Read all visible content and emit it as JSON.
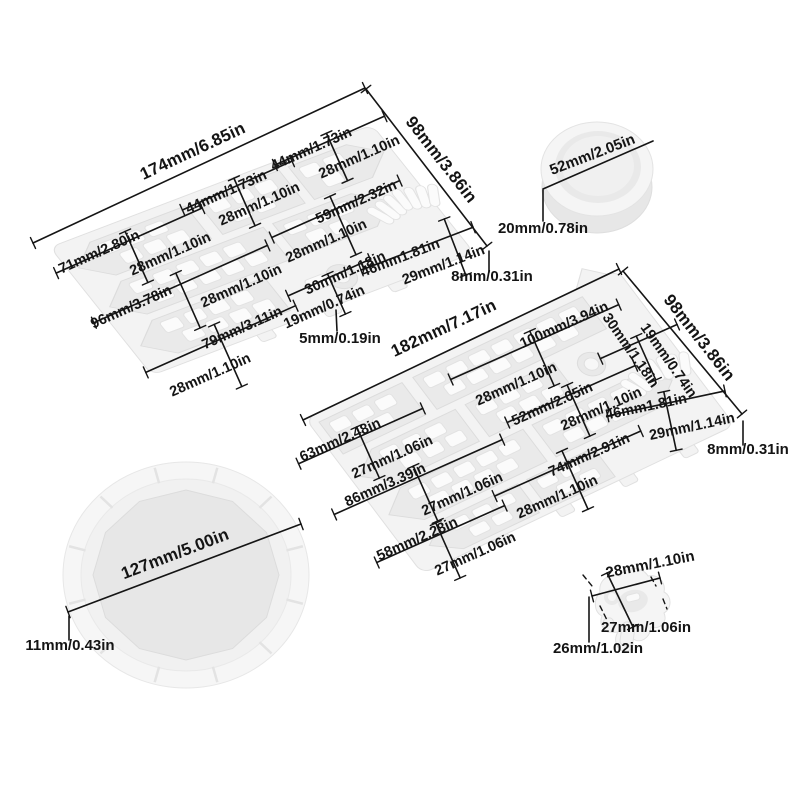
{
  "colors": {
    "background": "#ffffff",
    "mold_fill": "#f3f3f3",
    "cavity_fill": "#eaeaea",
    "piece_fill": "#fbfbfb",
    "dimension_line": "#151515",
    "label_text": "#141414"
  },
  "annotations": {
    "singles": [
      {
        "text": "174mm/6.85in",
        "x": 195,
        "y": 156,
        "rot": -25,
        "size": "lg",
        "line": [
          33,
          243,
          365,
          88
        ],
        "ticks": true
      },
      {
        "text": "98mm/3.86in",
        "x": 437,
        "y": 163,
        "rot": 52,
        "size": "lg",
        "line": [
          366,
          89,
          487,
          246
        ],
        "ticks": true
      },
      {
        "text": "52mm/2.05in",
        "x": 594,
        "y": 159,
        "rot": -21,
        "size": "md",
        "line": [
          543,
          189,
          653,
          141
        ],
        "ticks": false
      },
      {
        "text": "20mm/0.78in",
        "x": 543,
        "y": 233,
        "rot": 0,
        "size": "md",
        "line": [
          543,
          190,
          543,
          221
        ],
        "ticks": false
      },
      {
        "text": "8mm/0.31in",
        "x": 492,
        "y": 281,
        "rot": 0,
        "size": "md",
        "line": [
          489,
          251,
          489,
          272
        ],
        "ticks": false
      },
      {
        "text": "182mm/7.17in",
        "x": 446,
        "y": 333,
        "rot": -25,
        "size": "lg",
        "line": [
          303,
          420,
          619,
          269
        ],
        "ticks": true
      },
      {
        "text": "98mm/3.86in",
        "x": 695,
        "y": 341,
        "rot": 52,
        "size": "lg",
        "line": [
          623,
          271,
          742,
          414
        ],
        "ticks": true
      },
      {
        "text": "8mm/0.31in",
        "x": 748,
        "y": 454,
        "rot": 0,
        "size": "md",
        "line": [
          743,
          421,
          743,
          445
        ],
        "ticks": false
      },
      {
        "text": "127mm/5.00in",
        "x": 177,
        "y": 559,
        "rot": -21,
        "size": "lg",
        "line": [
          68,
          612,
          301,
          524
        ],
        "ticks": true
      },
      {
        "text": "11mm/0.43in",
        "x": 70,
        "y": 650,
        "rot": 0,
        "size": "md",
        "line": [
          69,
          616,
          69,
          640
        ],
        "ticks": false
      },
      {
        "text": "5mm/0.19in",
        "x": 340,
        "y": 343,
        "rot": 0,
        "size": "md",
        "line": [
          336,
          310,
          337,
          331
        ],
        "ticks": false
      },
      {
        "text": "26mm/1.02in",
        "x": 598,
        "y": 653,
        "rot": 0,
        "size": "md",
        "line": [
          589,
          597,
          589,
          642
        ],
        "ticks": false
      },
      {
        "text": "28mm/1.10in",
        "x": 651,
        "y": 569,
        "rot": -11,
        "size": "md",
        "line": [
          592,
          596,
          660,
          578
        ],
        "ticks": true
      },
      {
        "text": "27mm/1.06in",
        "x": 646,
        "y": 632,
        "rot": 0,
        "size": "md",
        "line": [
          607,
          573,
          633,
          627
        ],
        "ticks": true
      }
    ],
    "pairs": [
      {
        "t": "44mm/1.73in",
        "x": 228,
        "y": 196,
        "t2": "28mm/1.10in",
        "x2": 261,
        "y2": 208,
        "rot": -24,
        "hl": 60,
        "phl": 26
      },
      {
        "t": "44mm/1.73in",
        "x": 313,
        "y": 153,
        "t2": "28mm/1.10in",
        "x2": 361,
        "y2": 161,
        "rot": -24,
        "hl": 60,
        "phl": 26
      },
      {
        "t": "59mm/2.32in",
        "x": 358,
        "y": 206,
        "t2": "28mm/1.10in",
        "x2": 328,
        "y2": 245,
        "rot": -24,
        "hl": 70,
        "phl": 32
      },
      {
        "t": "71mm/2.80in",
        "x": 101,
        "y": 256,
        "t2": "28mm/1.10in",
        "x2": 172,
        "y2": 258,
        "rot": -24,
        "hl": 80,
        "phl": 28
      },
      {
        "t": "96mm/3.78in",
        "x": 133,
        "y": 311,
        "t2": "28mm/1.10in",
        "x2": 243,
        "y2": 290,
        "rot": -24,
        "hl": 95,
        "phl": 30
      },
      {
        "t": "79mm/3.11in",
        "x": 244,
        "y": 332,
        "t2": "28mm/1.10in",
        "x2": 212,
        "y2": 379,
        "rot": -24,
        "hl": 82,
        "phl": 34
      },
      {
        "t": "30mm/1.18in",
        "x": 347,
        "y": 277,
        "t2": "19mm/0.74in",
        "x2": 326,
        "y2": 311,
        "rot": -24,
        "hl": 45,
        "phl": 22
      },
      {
        "t": "46mm1.81in",
        "x": 402,
        "y": 262,
        "t2": "29mm/1.14in",
        "x2": 445,
        "y2": 269,
        "rot": -21,
        "hl": 60,
        "phl": 30,
        "pcx": 455,
        "pcy": 247
      },
      {
        "t": "100mm/3.94in",
        "x": 566,
        "y": 329,
        "t2": "28mm/1.10in",
        "x2": 518,
        "y2": 388,
        "rot": -24,
        "hl": 92,
        "phl": 30
      },
      {
        "t": "30mm/1.18in",
        "x": 627,
        "y": 353,
        "t2": "19mm/0.74in",
        "x2": 665,
        "y2": 363,
        "rot": -24,
        "trot": 55,
        "hl": 42,
        "phl": 24
      },
      {
        "t": "52mm/2.05in",
        "x": 554,
        "y": 408,
        "t2": "28mm/1.10in",
        "x2": 603,
        "y2": 413,
        "rot": -24,
        "hl": 70,
        "phl": 28
      },
      {
        "t": "46mm1.81in",
        "x": 647,
        "y": 411,
        "t2": "29mm/1.14in",
        "x2": 693,
        "y2": 431,
        "rot": -12,
        "hl": 60,
        "phl": 30
      },
      {
        "t": "63mm/2.48in",
        "x": 342,
        "y": 444,
        "t2": "27mm/1.06in",
        "x2": 394,
        "y2": 461,
        "rot": -24,
        "hl": 68,
        "phl": 28
      },
      {
        "t": "86mm/3.39in",
        "x": 387,
        "y": 489,
        "t2": "27mm/1.06in",
        "x2": 464,
        "y2": 498,
        "rot": -24,
        "hl": 92,
        "phl": 30
      },
      {
        "t": "74mm/2.91in",
        "x": 591,
        "y": 459,
        "t2": "28mm/1.10in",
        "x2": 559,
        "y2": 501,
        "rot": -24,
        "hl": 80,
        "phl": 32
      },
      {
        "t": "58mm/2.28in",
        "x": 419,
        "y": 543,
        "t2": "27mm/1.06in",
        "x2": 477,
        "y2": 558,
        "rot": -24,
        "hl": 70,
        "phl": 30
      }
    ],
    "extension_lines": [
      [
        583,
        575,
        592,
        586
      ],
      [
        600,
        606,
        607,
        620
      ],
      [
        651,
        577,
        656,
        586
      ],
      [
        663,
        599,
        667,
        609
      ]
    ]
  }
}
